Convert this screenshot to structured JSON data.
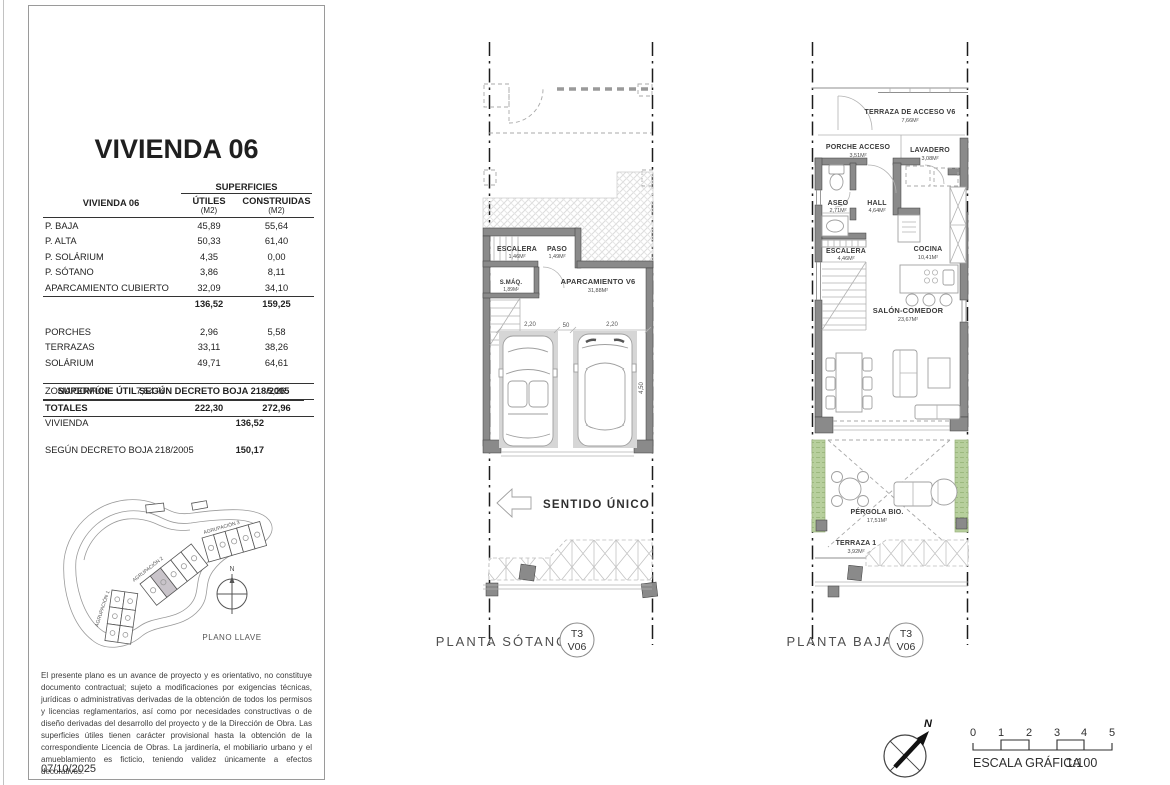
{
  "left_panel": {
    "title": "VIVIENDA 06",
    "table": {
      "row_header": "VIVIENDA 06",
      "superficies": "SUPERFICIES",
      "col_utiles": "ÚTILES",
      "col_construidas": "CONSTRUIDAS",
      "unit_utiles": "(M2)",
      "unit_construidas": "(M2)",
      "rows": [
        {
          "label": "P. BAJA",
          "utiles": "45,89",
          "construidas": "55,64"
        },
        {
          "label": "P. ALTA",
          "utiles": "50,33",
          "construidas": "61,40"
        },
        {
          "label": "P. SOLÁRIUM",
          "utiles": "4,35",
          "construidas": "0,00"
        },
        {
          "label": "P. SÓTANO",
          "utiles": "3,86",
          "construidas": "8,11"
        },
        {
          "label": "APARCAMIENTO CUBIERTO",
          "utiles": "32,09",
          "construidas": "34,10"
        }
      ],
      "subtotal_utiles": "136,52",
      "subtotal_construidas": "159,25",
      "rows2": [
        {
          "label": "PORCHES",
          "utiles": "2,96",
          "construidas": "5,58"
        },
        {
          "label": "TERRAZAS",
          "utiles": "33,11",
          "construidas": "38,26"
        },
        {
          "label": "SOLÁRIUM",
          "utiles": "49,71",
          "construidas": "64,61"
        }
      ],
      "zona_comun_label": "ZONA COMÚN",
      "zona_comun_pct": "7,54 %",
      "zona_comun_construidas": "5,26",
      "totales_label": "TOTALES",
      "totales_utiles": "222,30",
      "totales_construidas": "272,96"
    },
    "decreto": {
      "title": "SUPERFICIE ÚTIL SEGÚN DECRETO BOJA 218/2005",
      "row1_label": "VIVIENDA",
      "row1_value": "136,52",
      "row2_label": "SEGÚN DECRETO BOJA 218/2005",
      "row2_value": "150,17"
    },
    "keyplan": {
      "agrupacion1": "AGRUPACIÓN 1",
      "agrupacion2": "AGRUPACIÓN 2",
      "agrupacion3": "AGRUPACIÓN 3",
      "north": "N",
      "caption": "PLANO LLAVE"
    },
    "disclaimer": "El presente plano es un avance de proyecto y es orientativo, no constituye documento contractual; sujeto a modificaciones por exigencias técnicas, jurídicas o administrativas derivadas de la obtención de todos los permisos y licencias reglamentarios, así como por necesidades constructivas o de diseño derivadas del desarrollo del proyecto y de la Dirección de Obra. Las superficies útiles tienen carácter provisional hasta la obtención de la correspondiente Licencia de Obras. La jardinería, el mobiliario urbano y el amueblamiento es ficticio, teniendo validez únicamente a efectos decorativos.",
    "date": "07/10/2025"
  },
  "plan_sotano": {
    "caption": "PLANTA SÓTANO",
    "badge_top": "T3",
    "badge_bottom": "V06",
    "sentido_unico": "SENTIDO ÚNICO",
    "rooms": {
      "escalera_name": "ESCALERA",
      "escalera_area": "1,46M²",
      "paso_name": "PASO",
      "paso_area": "1,49M²",
      "smaq_name": "S.MÁQ.",
      "smaq_area": "1,89M²",
      "aparcamiento_name": "APARCAMIENTO V6",
      "aparcamiento_area": "31,88M²"
    },
    "dims": {
      "bay1": "2,20",
      "gap": "50",
      "bay2": "2,20",
      "depth": "4,50"
    }
  },
  "plan_baja": {
    "caption": "PLANTA BAJA",
    "badge_top": "T3",
    "badge_bottom": "V06",
    "rooms": {
      "terraza_acceso_name": "TERRAZA DE ACCESO V6",
      "terraza_acceso_area": "7,66M²",
      "porche_name": "PORCHE ACCESO",
      "porche_area": "3,51M²",
      "lavadero_name": "LAVADERO",
      "lavadero_area": "3,08M²",
      "aseo_name": "ASEO",
      "aseo_area": "2,71M²",
      "hall_name": "HALL",
      "hall_area": "4,64M²",
      "escalera_name": "ESCALERA",
      "escalera_area": "4,46M²",
      "cocina_name": "COCINA",
      "cocina_area": "10,41M²",
      "salon_name": "SALÓN-COMEDOR",
      "salon_area": "23,67M²",
      "pergola_name": "PÉRGOLA BIO.",
      "pergola_area": "17,51M²",
      "terraza1_name": "TERRAZA 1",
      "terraza1_area": "3,92M²"
    }
  },
  "footer": {
    "north": "N",
    "scale_numbers": [
      "0",
      "1",
      "2",
      "3",
      "4",
      "5"
    ],
    "scale_label": "ESCALA GRÁFICA",
    "scale_ratio": "1:100"
  },
  "colors": {
    "wall_gray": "#8a8a8a",
    "pergola_green": "#b7cf9d",
    "highlight_unit": "#c9c4ca"
  }
}
